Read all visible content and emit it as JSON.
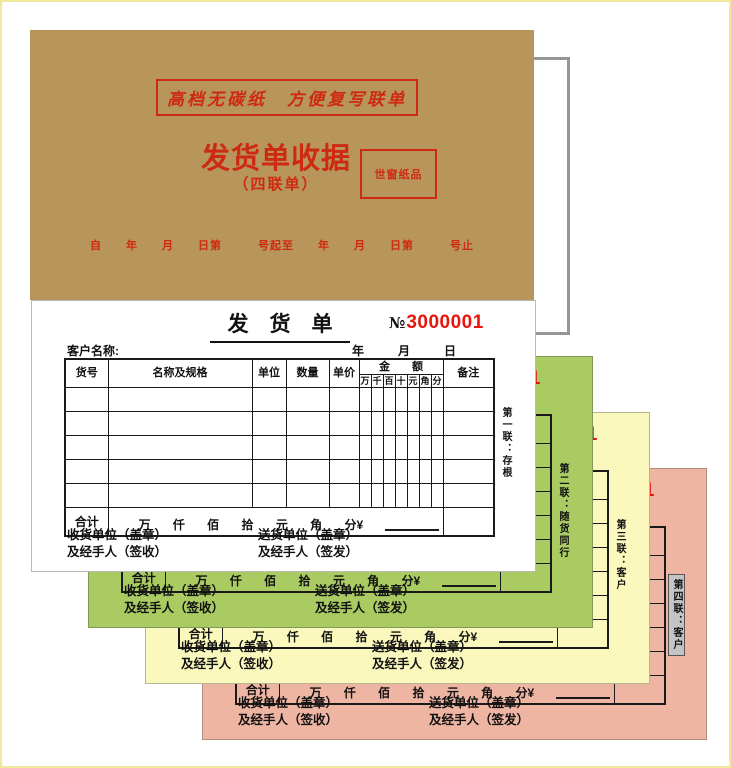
{
  "cover": {
    "slogan": "高档无碳纸　方便复写联单",
    "title": "发货单收据",
    "subtitle": "（四联单）",
    "stamp": "世窗纸品",
    "date_line": "自　　年　　月　　日第　　　号起至　　年　　月　　日第　　　号止",
    "bg_color": "#B8955A",
    "red_color": "#CE2A12"
  },
  "form": {
    "title": "发　货　单",
    "serial_prefix": "№",
    "serial_number": "3000001",
    "serial_color": "#E8150D",
    "customer_label": "客户名称:",
    "date_chars": [
      "年",
      "月",
      "日"
    ],
    "table": {
      "headers": [
        "货号",
        "名称及规格",
        "单位",
        "数量",
        "单价",
        "备注"
      ],
      "amount_header": "金　　额",
      "amount_digits": [
        "万",
        "千",
        "百",
        "十",
        "元",
        "角",
        "分"
      ],
      "empty_rows": 5,
      "total_label": "合计",
      "total_units": [
        "万",
        "仟",
        "佰",
        "拾",
        "元",
        "角",
        "分¥"
      ]
    },
    "footer": {
      "receiver_line1": "收货单位（盖章）",
      "receiver_line2": "及经手人（签收）",
      "sender_line1": "送货单位（盖章）",
      "sender_line2": "及经手人（签发）"
    }
  },
  "sheets": [
    {
      "label": "第一联：存根",
      "color": "#FFFFFF",
      "highlight": false
    },
    {
      "label": "第二联：随货同行",
      "color": "#A9CB62",
      "highlight": false
    },
    {
      "label": "第三联：客户",
      "color": "#FBF8BD",
      "highlight": false
    },
    {
      "label": "第四联：客户",
      "color": "#EFB5A3",
      "highlight": true
    }
  ]
}
